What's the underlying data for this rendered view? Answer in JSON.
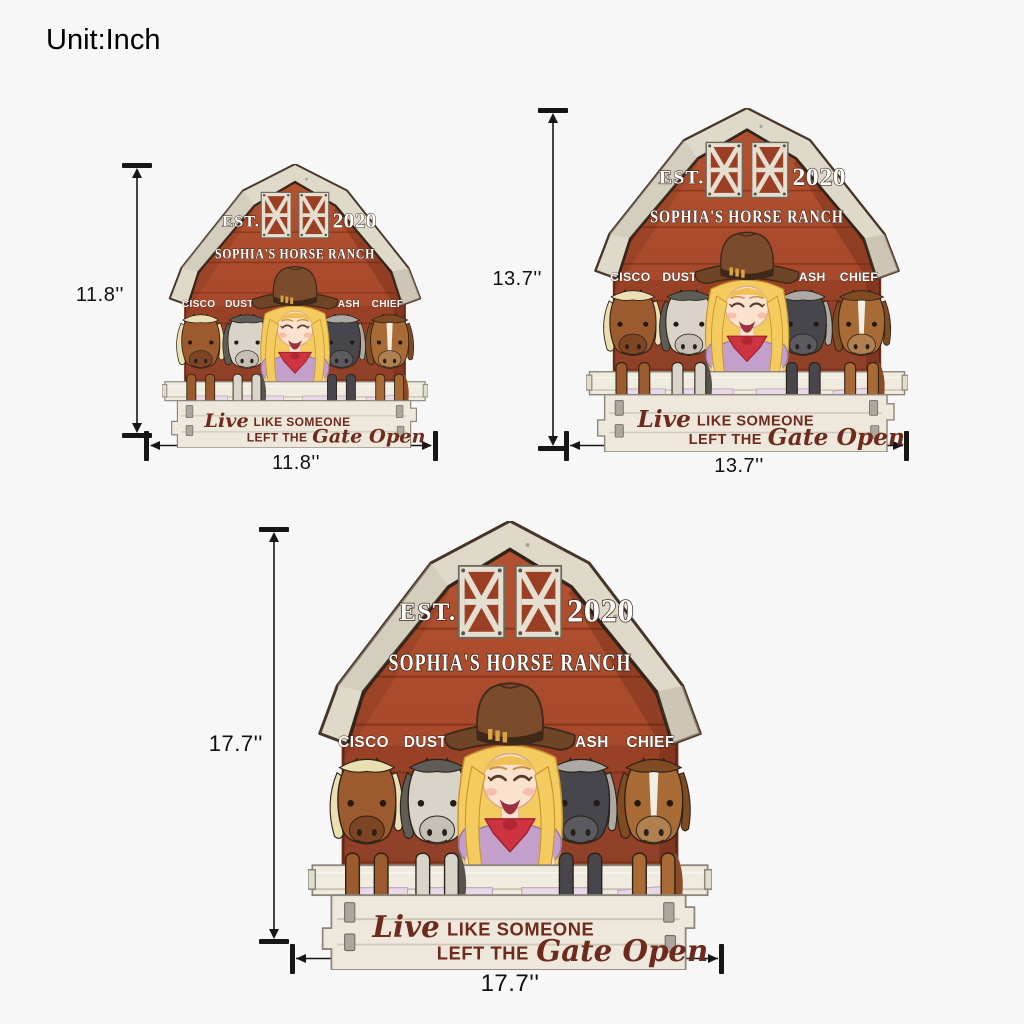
{
  "page": {
    "unit_label": "Unit:Inch",
    "background": "#F7F7F7"
  },
  "sign": {
    "est_label": "EST.",
    "est_year": "2020",
    "ranch_name": "SOPHIA'S HORSE RANCH",
    "horse_names": [
      "CISCO",
      "DUSTY",
      "CASH",
      "CHIEF"
    ],
    "quote": {
      "script_open": "Live",
      "caps_line1": "LIKE SOMEONE",
      "caps_line2": "LEFT THE",
      "script_close": "Gate Open"
    },
    "colors": {
      "barn_red": "#A8492C",
      "roof_cream": "#DFD9C9",
      "fence_cream": "#EDE8DB",
      "quote_text": "#6E2A1C",
      "plate_pink": "#E9D8E6",
      "dimension_ink": "#161616"
    }
  },
  "sizes": [
    {
      "name": "small",
      "height_label": "11.8''",
      "width_label": "11.8''"
    },
    {
      "name": "medium",
      "height_label": "13.7''",
      "width_label": "13.7''"
    },
    {
      "name": "large",
      "height_label": "17.7''",
      "width_label": "17.7''"
    }
  ]
}
